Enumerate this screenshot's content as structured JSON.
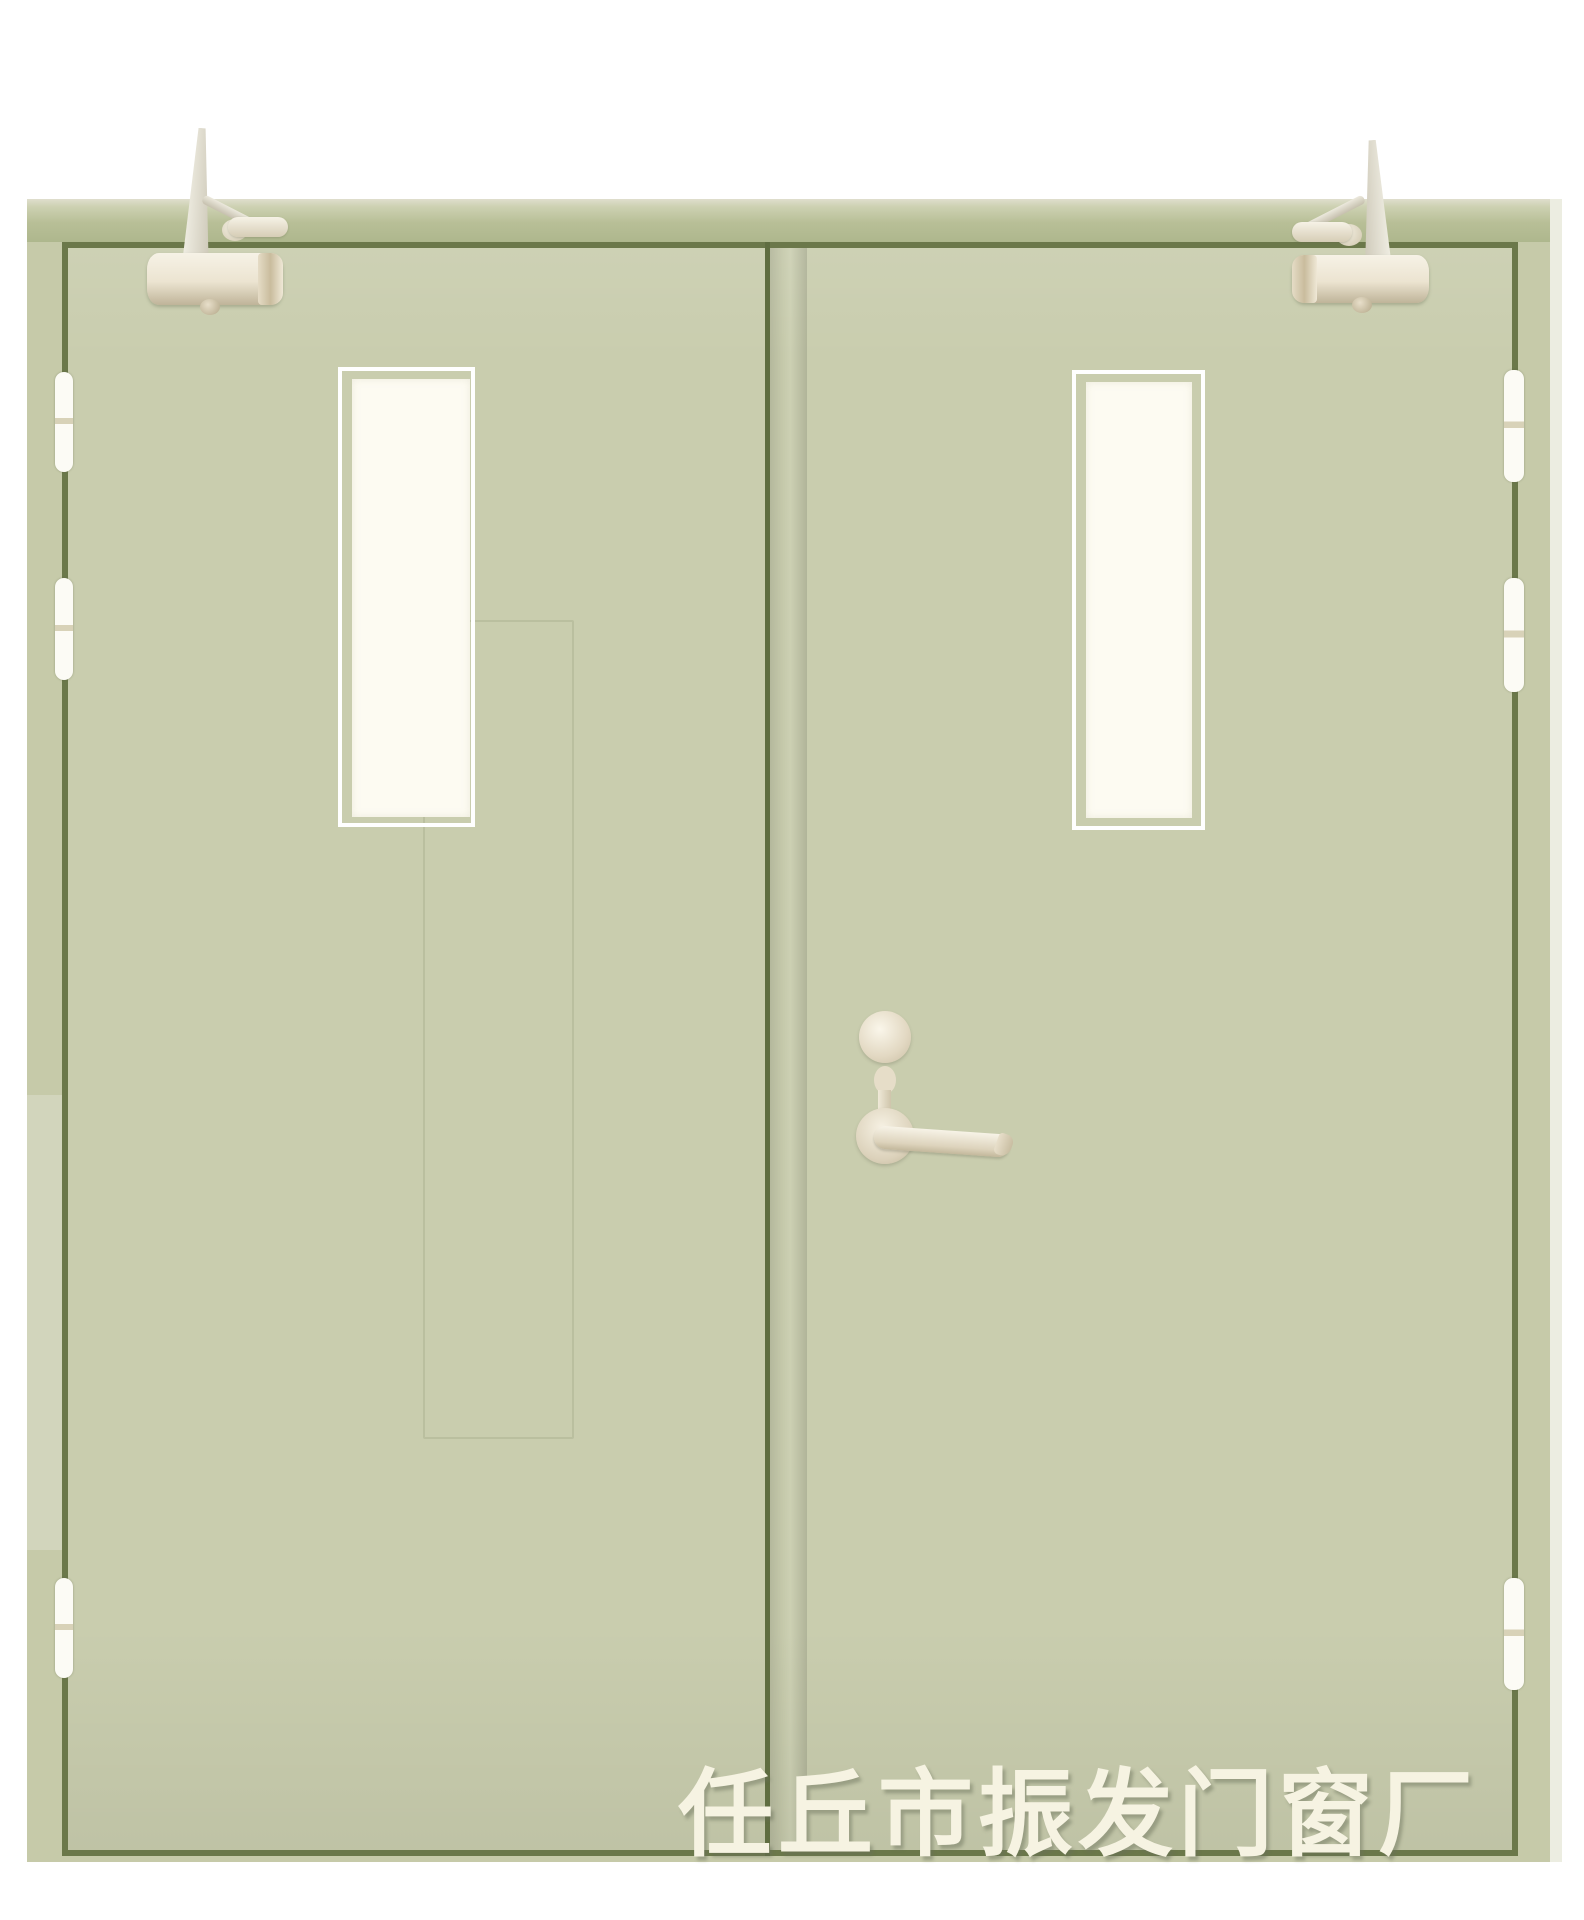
{
  "photo": {
    "subject": "Double-leaf pale-green steel fire door with narrow vision panels, overhead door closers, three hinge pairs per side and a lever handle",
    "watermark": "任丘市振发门窗厂"
  },
  "theme": {
    "background": "#ffffff",
    "frame_band": "#b8bf97",
    "frame_band_light": "#dfdecd",
    "frame_strip": "#c6caa9",
    "frame_edge_light": "#ecede1",
    "outline_dark": "#6b784a",
    "stile_dark": "#5f6d40",
    "leaf": "#c9cdae",
    "glass": "#fdfbf2",
    "glass_trim": "#ffffff",
    "hinge_white": "#fcfbf5",
    "hw_light": "#f6f2e6",
    "hw_dark": "#bfb499",
    "watermark_color": "#f6f3e2"
  }
}
